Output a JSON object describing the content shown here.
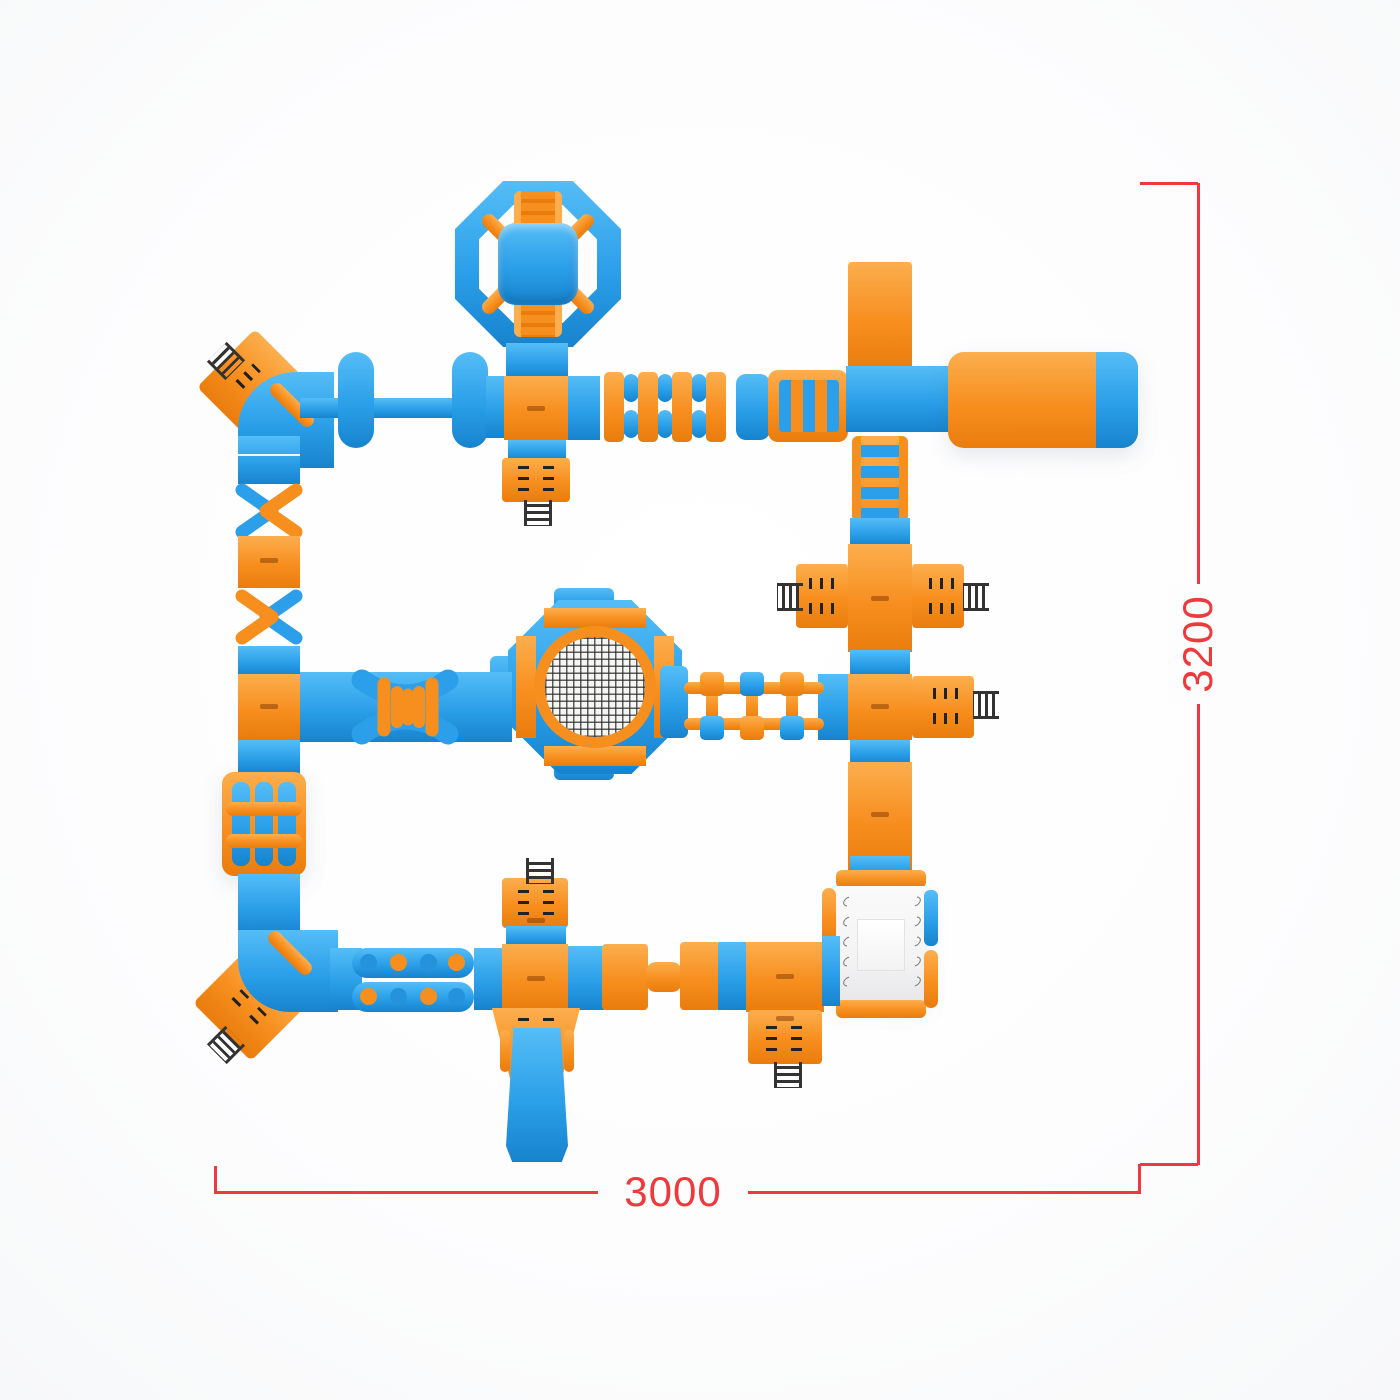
{
  "scene": {
    "description": "Top view render of a modular inflatable water park obstacle course in blue and orange, annotated with red dimension lines",
    "dimension_annotations": {
      "height_label": "3200",
      "width_label": "3000"
    },
    "modules": [
      "octagon-climb-tower",
      "balance-beam-with-crossbars",
      "junction-pads",
      "roller-hurdles",
      "rung-bridge",
      "slide-tower",
      "landing-pool",
      "climb-steps",
      "entry-platforms-with-ladders",
      "octagon-trampoline-mesh",
      "step-block-bridge",
      "crossover-x-obstacles",
      "roller-cage",
      "squeeze-rollers",
      "stepping-pods",
      "center-slide",
      "white-climb-wedge",
      "corner-elbows"
    ]
  },
  "colors": {
    "blue": "#2B9FE9",
    "blue_hi": "#55BDF6",
    "blue_lo": "#1783CD",
    "orange": "#F78F1F",
    "orange_hi": "#FCAE4E",
    "orange_lo": "#E97C0C",
    "red": "#EE3A3C",
    "ink": "#222222",
    "white_block": "#F4F4F5"
  }
}
